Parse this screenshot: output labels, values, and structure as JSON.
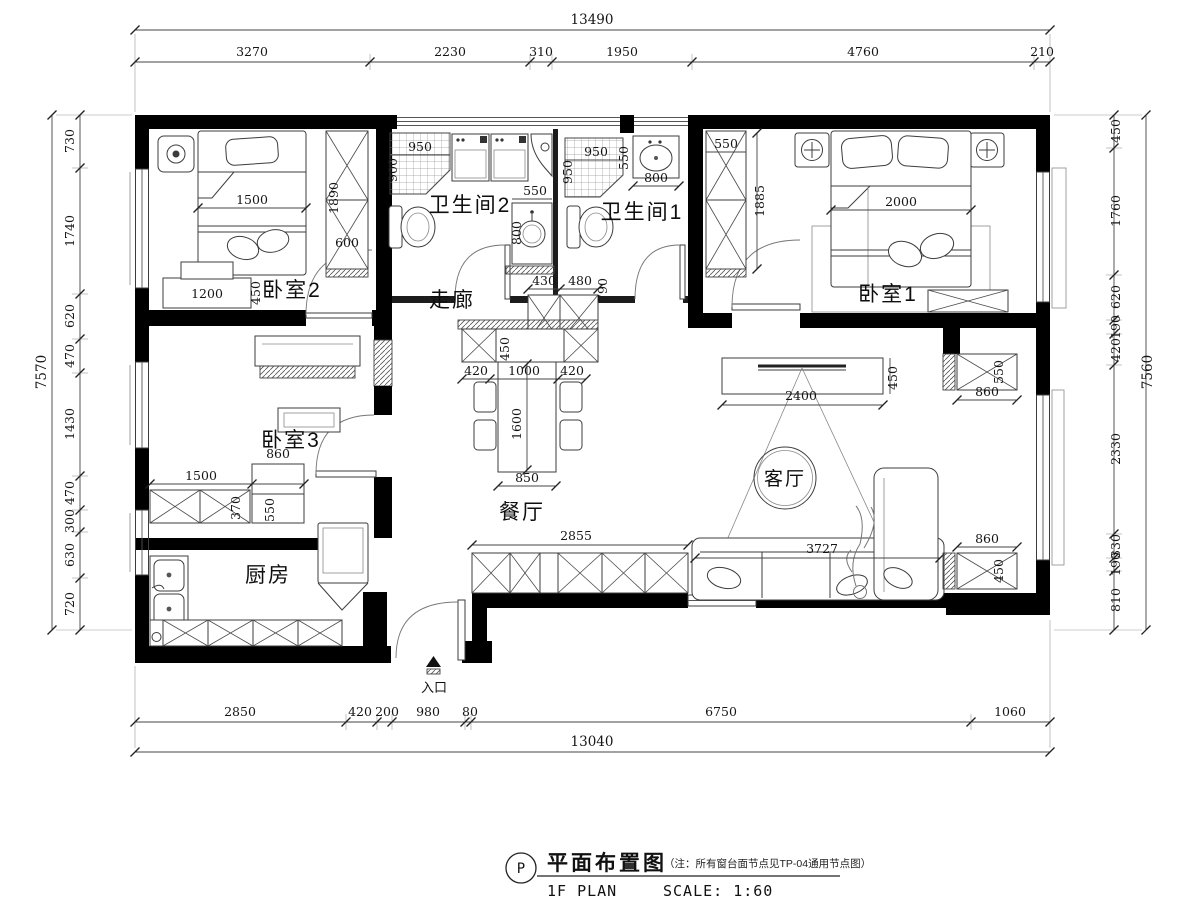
{
  "title_block": {
    "tag": "P",
    "title": "平面布置图",
    "note": "（注：所有窗台面节点见TP-04通用节点图）",
    "subtitle_left": "1F PLAN",
    "subtitle_right": "SCALE: 1:60"
  },
  "entrance": {
    "label": "入口"
  },
  "rooms": {
    "bedroom1": "卧室1",
    "bedroom2": "卧室2",
    "bedroom3": "卧室3",
    "bath1": "卫生间1",
    "bath2": "卫生间2",
    "corridor": "走廊",
    "kitchen": "厨房",
    "dining": "餐厅",
    "living": "客厅"
  },
  "dims": {
    "top": {
      "overall": "13490",
      "segments": [
        "3270",
        "2230",
        "310",
        "1950",
        "4760",
        "210"
      ]
    },
    "bottom": {
      "overall": "13040",
      "segments": [
        "2850",
        "420",
        "200",
        "980",
        "80",
        "6750",
        "1060"
      ]
    },
    "left": {
      "overall": "7570",
      "segments": [
        "730",
        "1740",
        "620",
        "470",
        "1430",
        "470",
        "300",
        "630",
        "720"
      ]
    },
    "right": {
      "overall": "7560",
      "segments": [
        "450",
        "1760",
        "620",
        "190",
        "420",
        "2330",
        "330",
        "190",
        "810"
      ]
    },
    "interior": {
      "bed2_bed": "1500",
      "bed2_wardrobe_h": "1890",
      "bed2_wardrobe_w": "600",
      "bed2_dresser": "1200",
      "bed2_dresser_d": "450",
      "bath2_shower_w": "950",
      "bath2_shower_h": "900",
      "vanity_w": "550",
      "vanity_h": "800",
      "bath1_shower_w": "950",
      "bath1_shower_h": "950",
      "bath1_sink_w": "550",
      "bath1_sink_d": "800",
      "corridor_cab1": "430",
      "corridor_cab2": "480",
      "corridor_cab_h": "790",
      "dining_cab_d": "450",
      "dining_left": "420",
      "dining_table_w": "1000",
      "dining_right": "420",
      "dining_table_l": "1600",
      "dining_table_end": "850",
      "dining_cab_row": "2855",
      "bed1_wardrobe_w": "550",
      "bed1_wardrobe_h": "1885",
      "bed1_bed": "2000",
      "bed3_counter": "1500",
      "bed3_cab_w": "860",
      "bed3_counter_d": "370",
      "bed3_cab_d": "550",
      "tv_console": "2400",
      "tv_console_d": "450",
      "sofa": "3727",
      "living_cab_top_d": "550",
      "living_cab_top_w": "860",
      "living_cab_bot_w": "860",
      "living_cab_bot_d": "450"
    }
  }
}
